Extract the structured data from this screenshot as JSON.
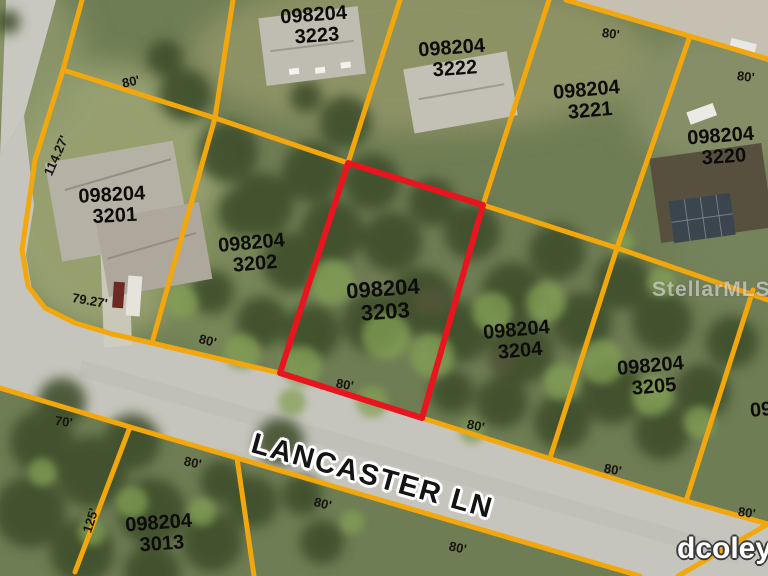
{
  "map": {
    "title": "parcel-aerial-map",
    "street": {
      "name": "LANCASTER LN"
    },
    "watermark": "StellarMLS",
    "credit": "dcoley",
    "colors": {
      "parcel_line": "#f2a70d",
      "highlight_outline": "#e8151f",
      "label_text": "#0e0c0a",
      "road": "#c6c5bd",
      "street_text": "#141414",
      "credit_text": "#ffffff"
    },
    "highlighted_parcel": {
      "id": "098204",
      "lot": "3203"
    },
    "parcels": [
      {
        "id": "098204",
        "lot": "3223"
      },
      {
        "id": "098204",
        "lot": "3222"
      },
      {
        "id": "098204",
        "lot": "3221"
      },
      {
        "id": "098204",
        "lot": "3220"
      },
      {
        "id": "098204",
        "lot": "3201"
      },
      {
        "id": "098204",
        "lot": "3202"
      },
      {
        "id": "098204",
        "lot": "3203"
      },
      {
        "id": "098204",
        "lot": "3204"
      },
      {
        "id": "098204",
        "lot": "3205"
      },
      {
        "id": "098204",
        "lot": "3013"
      }
    ],
    "partials": {
      "top": "3224",
      "right": "098204"
    },
    "dims": [
      "80'",
      "80'",
      "80'",
      "114.27'",
      "79.27'",
      "70'",
      "125'",
      "80'",
      "80'",
      "80'",
      "80'",
      "80'",
      "80'",
      "80'",
      "80'"
    ]
  }
}
